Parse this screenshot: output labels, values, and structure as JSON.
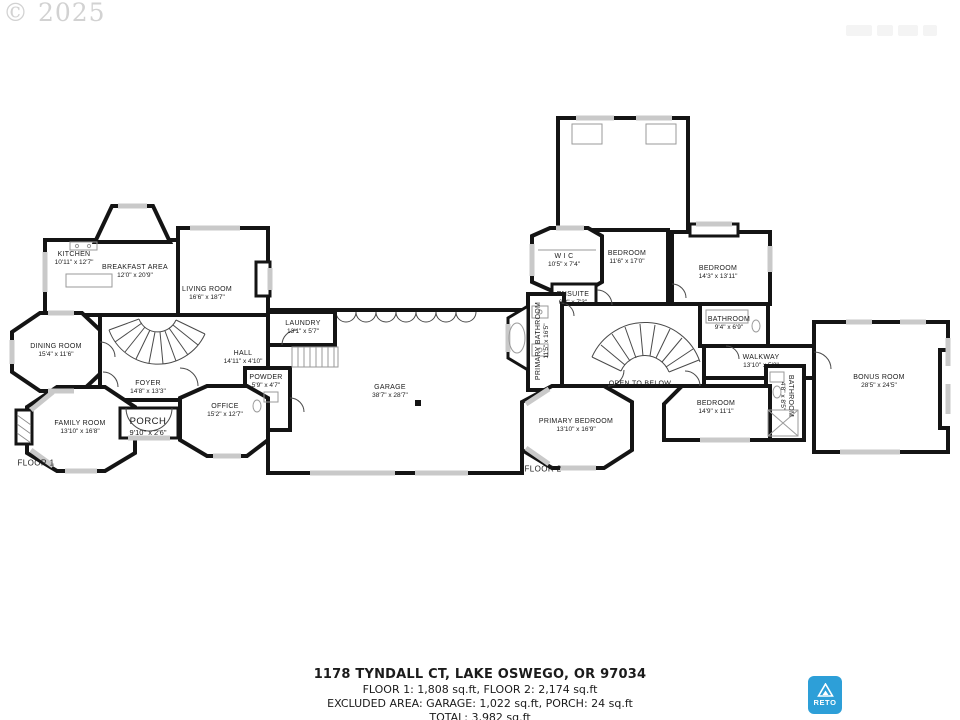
{
  "watermark": {
    "copyright": "© 2025"
  },
  "floors": [
    {
      "label": "FLOOR 1",
      "rooms": [
        {
          "name": "KITCHEN",
          "dims": "10'11\" x 12'7\""
        },
        {
          "name": "BREAKFAST AREA",
          "dims": "12'0\" x 20'9\""
        },
        {
          "name": "LIVING ROOM",
          "dims": "16'6\" x 18'7\""
        },
        {
          "name": "DINING ROOM",
          "dims": "15'4\" x 11'6\""
        },
        {
          "name": "LAUNDRY",
          "dims": "13'1\" x 5'7\""
        },
        {
          "name": "HALL",
          "dims": "14'11\" x 4'10\""
        },
        {
          "name": "POWDER",
          "dims": "5'9\" x 4'7\""
        },
        {
          "name": "FOYER",
          "dims": "14'8\" x 13'3\""
        },
        {
          "name": "FAMILY ROOM",
          "dims": "13'10\" x 16'8\""
        },
        {
          "name": "OFFICE",
          "dims": "15'2\" x 12'7\""
        },
        {
          "name": "PORCH",
          "dims": "9'10\" x 2'6\""
        },
        {
          "name": "GARAGE",
          "dims": "38'7\" x 28'7\""
        }
      ]
    },
    {
      "label": "FLOOR 2",
      "rooms": [
        {
          "name": "W I C",
          "dims": "10'5\" x 7'4\""
        },
        {
          "name": "BEDROOM",
          "dims": "11'6\" x 17'0\""
        },
        {
          "name": "BEDROOM",
          "dims": "14'3\" x 13'11\""
        },
        {
          "name": "ENSUITE",
          "dims": "6'3\" x 7'3\""
        },
        {
          "name": "PRIMARY BATHROOM",
          "dims": "11'5\" x 16'5\""
        },
        {
          "name": "BATHROOM",
          "dims": "9'4\" x 6'9\""
        },
        {
          "name": "WALKWAY",
          "dims": "13'10\" x 5'2\""
        },
        {
          "name": "BONUS ROOM",
          "dims": "28'5\" x 24'5\""
        },
        {
          "name": "OPEN TO BELOW",
          "dims": ""
        },
        {
          "name": "PRIMARY BEDROOM",
          "dims": "13'10\" x 16'9\""
        },
        {
          "name": "BEDROOM",
          "dims": "14'9\" x 11'1\""
        },
        {
          "name": "BATHROOM",
          "dims": "4'8\" x 8'5\""
        }
      ]
    }
  ],
  "caption": {
    "address": "1178 TYNDALL CT, LAKE OSWEGO, OR 97034",
    "floor_areas": "FLOOR 1: 1,808 sq.ft, FLOOR 2: 2,174 sq.ft",
    "excluded": "EXCLUDED AREA: GARAGE: 1,022 sq.ft, PORCH: 24 sq.ft",
    "total": "TOTAL: 3,982 sq.ft",
    "disclaimer": "SIZES AND DIMENSIONS ARE APPROXIMATE, ACTUAL MAY VARY"
  },
  "logo": {
    "text": "RETO",
    "color": "#2d9fd8"
  }
}
